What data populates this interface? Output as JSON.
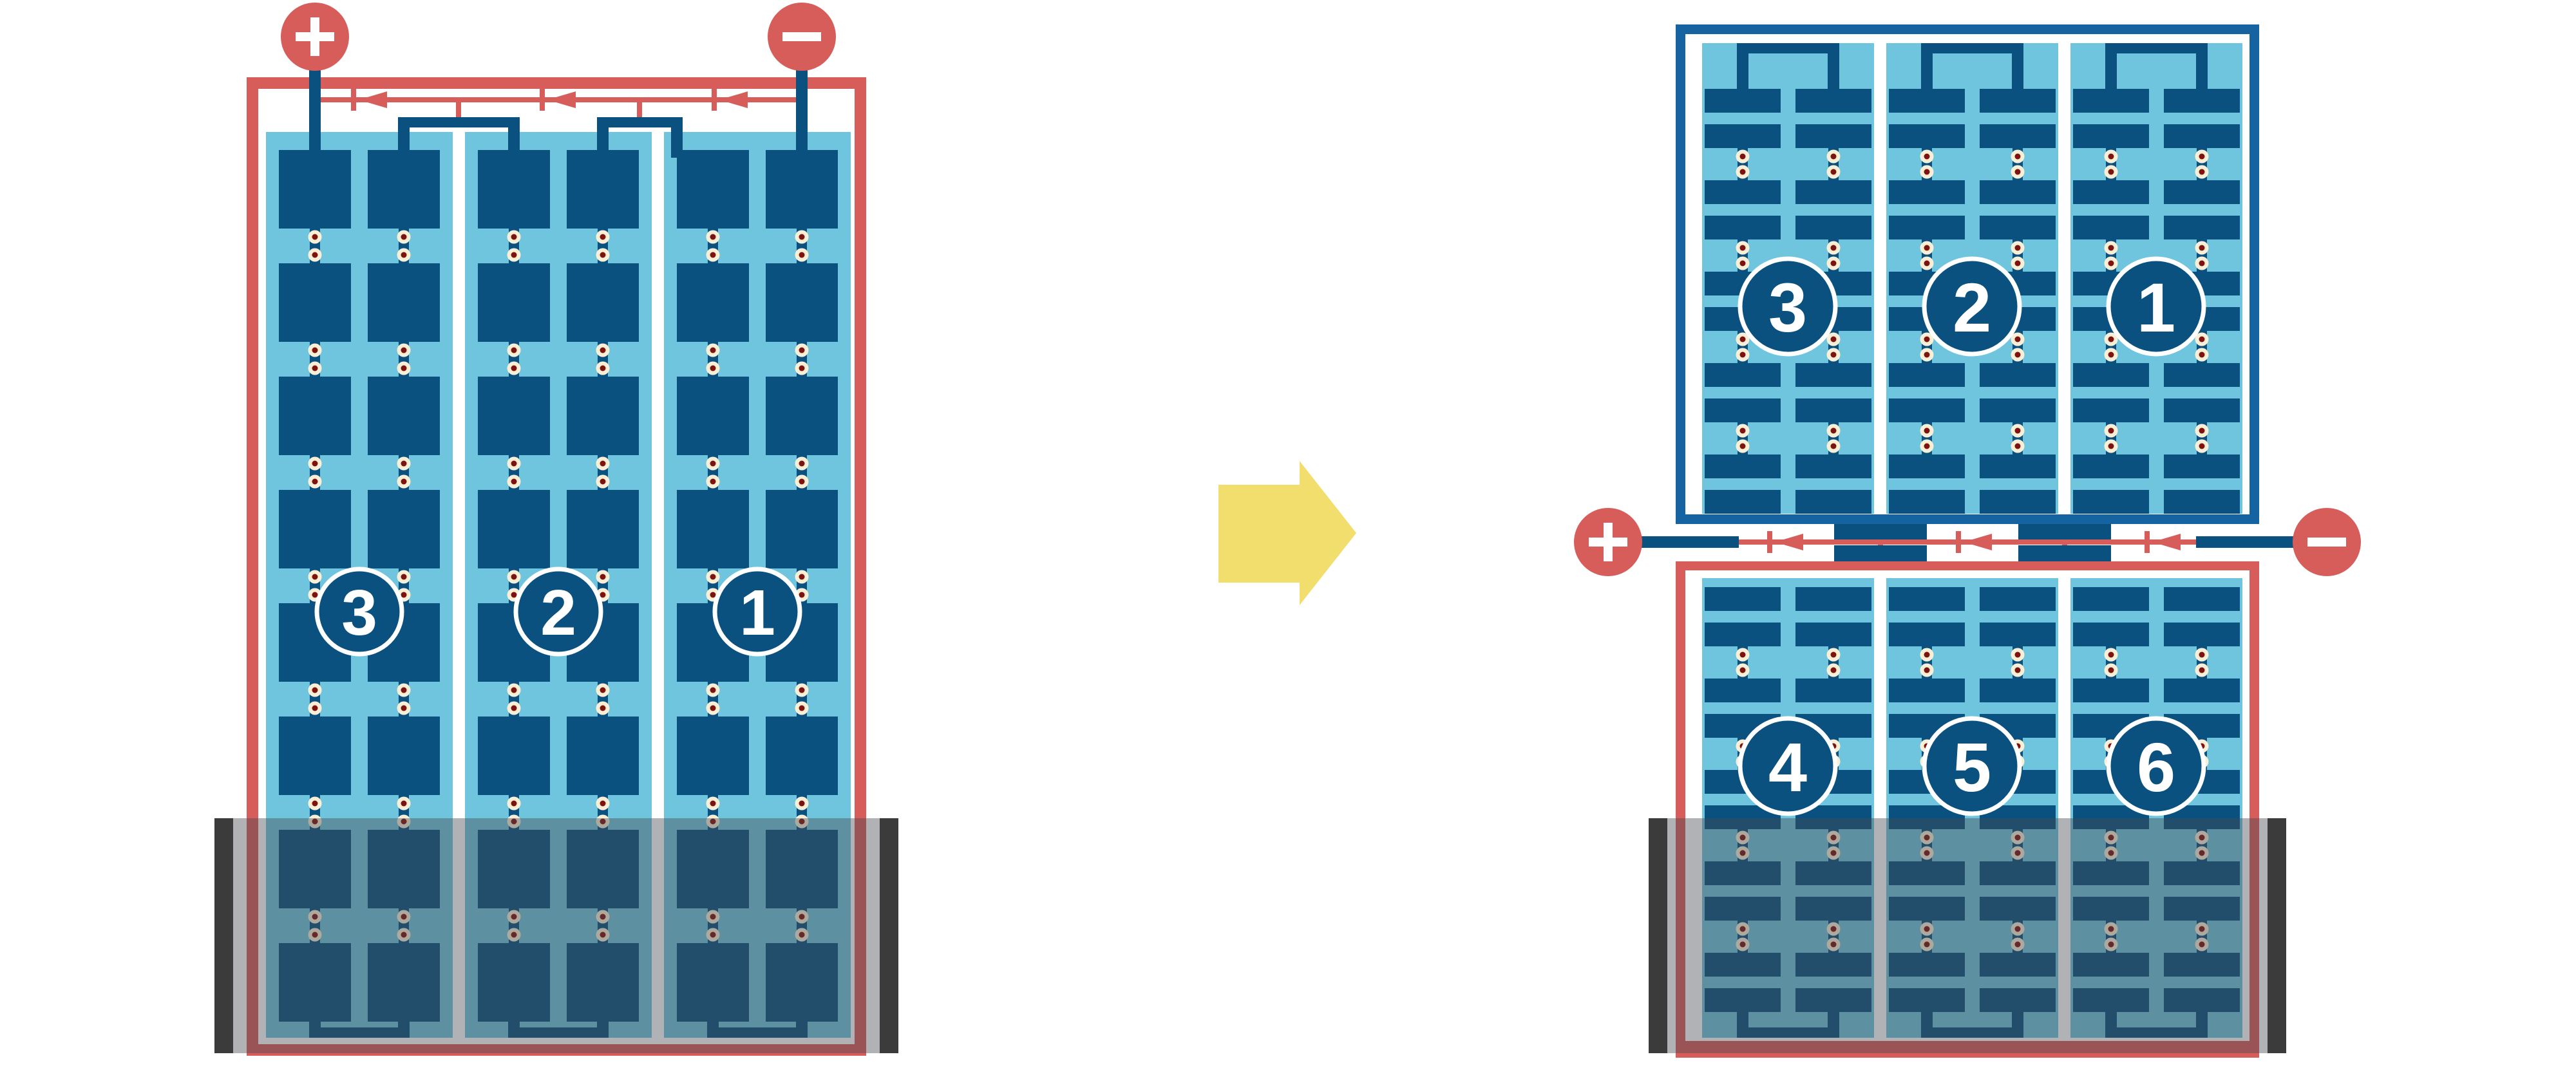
{
  "colors": {
    "background": "#FFFFFF",
    "red": "#D75D5B",
    "dark_blue": "#0A5180",
    "frame_blue": "#1563A0",
    "light_blue": "#6FC5DD",
    "cream": "#F9EFD7",
    "dot_red": "#7E120D",
    "yellow": "#F1DE6D",
    "white": "#FFFFFF",
    "shade_overlay": "rgba(70,72,78,0.42)",
    "shade_bar": "#3B3B3B"
  },
  "left_panel": {
    "positive_terminal": "+",
    "negative_terminal": "−",
    "string_labels": [
      "3",
      "2",
      "1"
    ],
    "bypass_diode_count": 3
  },
  "right_panel": {
    "positive_terminal": "+",
    "negative_terminal": "−",
    "top_string_labels": [
      "3",
      "2",
      "1"
    ],
    "bottom_string_labels": [
      "4",
      "5",
      "6"
    ],
    "bypass_diode_count": 3
  },
  "arrow": {
    "direction": "right"
  }
}
